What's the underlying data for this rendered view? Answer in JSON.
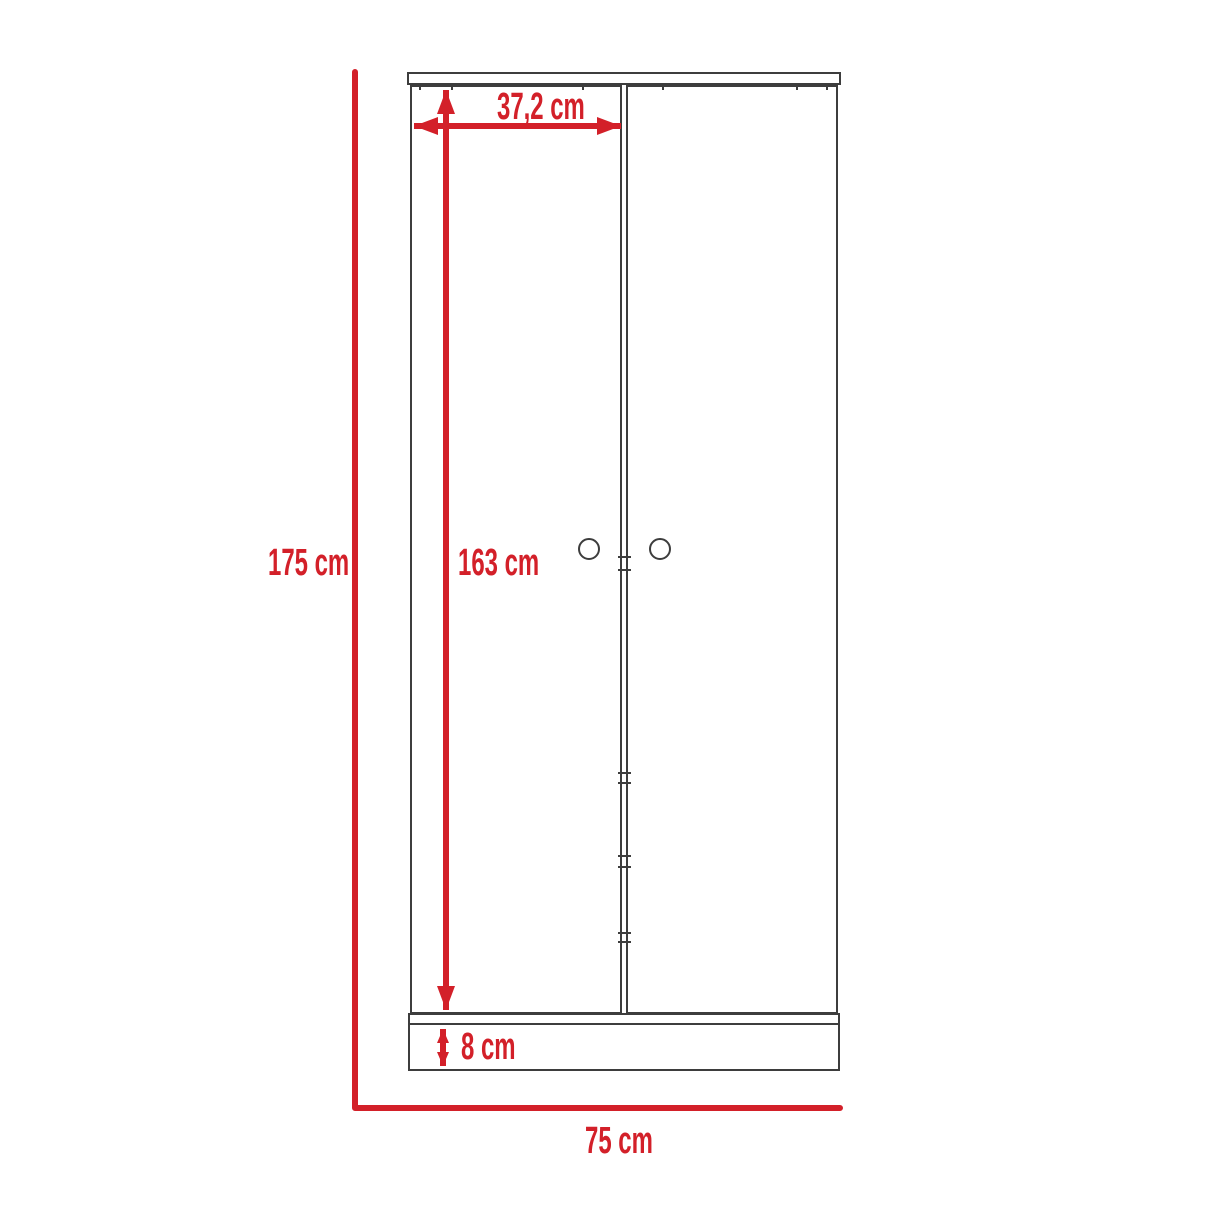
{
  "title": "Wardrobe front-view dimension diagram",
  "colors": {
    "accent": "#d32029",
    "ink": "#3d3d3d",
    "background": "#ffffff"
  },
  "unit": "cm",
  "dimensions": {
    "total_height": {
      "label": "175 cm",
      "value": 175
    },
    "door_width": {
      "label": "37,2 cm",
      "value": 37.2
    },
    "door_height": {
      "label": "163 cm",
      "value": 163
    },
    "base_height": {
      "label": "8 cm",
      "value": 8
    },
    "total_width": {
      "label": "75 cm",
      "value": 75
    }
  }
}
